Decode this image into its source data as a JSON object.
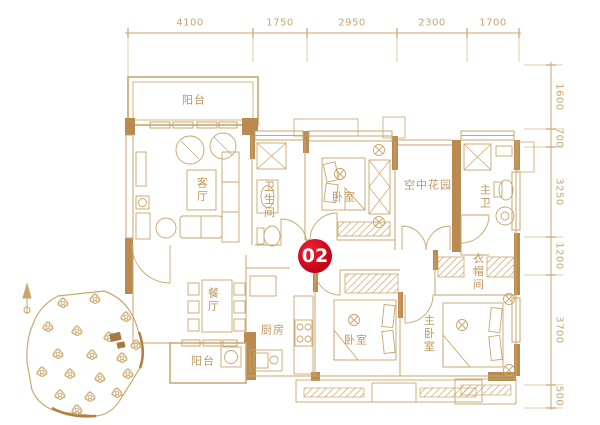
{
  "unit_badge": "02",
  "dimensions": {
    "top": [
      "4100",
      "1750",
      "2950",
      "2300",
      "1700"
    ],
    "right": [
      "1600",
      "700",
      "3250",
      "1200",
      "3700",
      "500"
    ]
  },
  "rooms": {
    "balcony_top": "阳台",
    "living_room": "客厅",
    "bathroom": "卫生间",
    "bedroom_top": "卧室",
    "sky_garden": "空中花园",
    "master_bath": "主卫",
    "dining_room": "餐厅",
    "kitchen": "厨房",
    "balcony_bottom": "阳台",
    "bedroom_bottom": "卧室",
    "master_bedroom": "主卧室",
    "cloakroom": "衣帽间"
  },
  "palette": {
    "line": "#c9a56c",
    "wall_fill": "#bb8a50",
    "badge_red": "#c00016",
    "badge_text": "#ffffff"
  }
}
